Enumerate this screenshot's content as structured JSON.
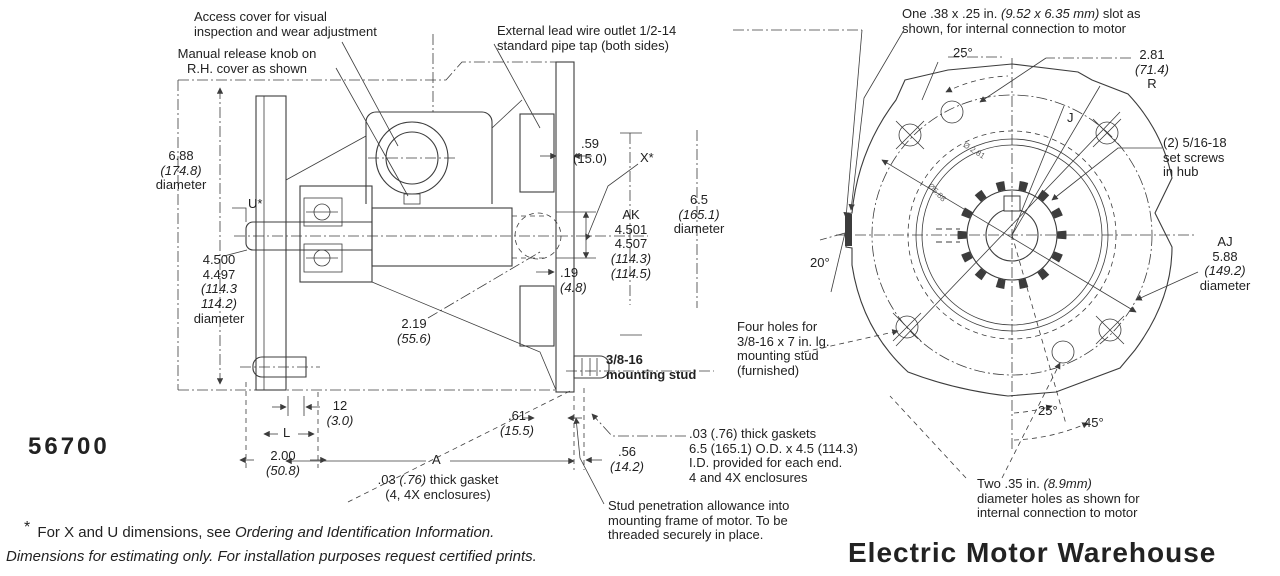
{
  "part_number": "56700",
  "brand": "Electric Motor Warehouse",
  "callouts": {
    "access_cover": "Access cover for visual\ninspection and wear adjustment",
    "manual_release": "Manual release knob on\nR.H. cover as shown",
    "lead_wire": "External lead wire outlet 1/2-14\nstandard pipe tap (both sides)",
    "mounting_stud": "3/8-16\nmounting stud",
    "gasket_single": {
      "pre": ".03 ",
      "metric": "(.76)",
      "post": " thick gasket",
      "line2": "(4, 4X enclosures)"
    },
    "gaskets_pair": ".03 (.76) thick gaskets\n6.5 (165.1) O.D. x 4.5 (114.3)\nI.D. provided for each end.\n4 and 4X enclosures",
    "stud_penetration": "Stud penetration allowance into\nmounting frame of motor. To be\nthreaded securely in place.",
    "slot": {
      "pre": "One .38 x .25 in. ",
      "metric": "(9.52 x 6.35 mm)",
      "post": " slot as",
      "line2": "shown, for internal connection to motor"
    },
    "set_screws": "(2) 5/16-18\nset screws\nin hub",
    "four_holes": "Four holes for\n3/8-16 x 7 in. lg.\nmounting stud\n(furnished)",
    "two_holes": {
      "pre": "Two .35 in. ",
      "metric": "(8.9mm)",
      "line2": "diameter holes as shown for",
      "line3": "internal connection to motor"
    }
  },
  "dims": {
    "d688": {
      "in": "6.88",
      "mm": "(174.8)",
      "label": "diameter"
    },
    "u_ref": "U*",
    "d45": {
      "in1": "4.500",
      "in2": "4.497",
      "mm1": "(114.3",
      "mm2": "114.2)",
      "label": "diameter"
    },
    "d059": {
      "in": ".59",
      "mm": "(15.0)"
    },
    "x_ref": "X*",
    "ak": {
      "ref": "AK",
      "in1": "4.501",
      "in2": "4.507",
      "mm1": "(114.3)",
      "mm2": "(114.5)"
    },
    "d65": {
      "in": "6.5",
      "mm": "(165.1)",
      "label": "diameter"
    },
    "d019": {
      "in": ".19",
      "mm": "(4.8)"
    },
    "d219": {
      "in": "2.19",
      "mm": "(55.6)"
    },
    "d012": {
      "in": "12",
      "mm": "(3.0)"
    },
    "l_ref": "L",
    "d200": {
      "in": "2.00",
      "mm": "(50.8)"
    },
    "a_ref": "A",
    "d061": {
      "in": ".61",
      "mm": "(15.5)"
    },
    "d056": {
      "in": ".56",
      "mm": "(14.2)"
    },
    "angle_25_top": "25°",
    "r281": {
      "in": "2.81",
      "mm": "(71.4)",
      "label": "R"
    },
    "j_ref": "J",
    "angle_20": "20°",
    "aj": {
      "ref": "AJ",
      "in": "5.88",
      "mm": "(149.2)",
      "label": "diameter"
    },
    "angle_25_bottom": "25°",
    "angle_45": "45°",
    "hub_bore": "Ø 2.81",
    "hub_pilot": "Ø5.88"
  },
  "footnotes": {
    "star": "*",
    "note1_pre": " For X and U dimensions, see ",
    "note1_ref": "Ordering and Identification Information.",
    "note2": "Dimensions for estimating only. For installation purposes request certified prints."
  },
  "colors": {
    "line": "#3c3c3c",
    "text": "#222222",
    "background": "#ffffff"
  }
}
